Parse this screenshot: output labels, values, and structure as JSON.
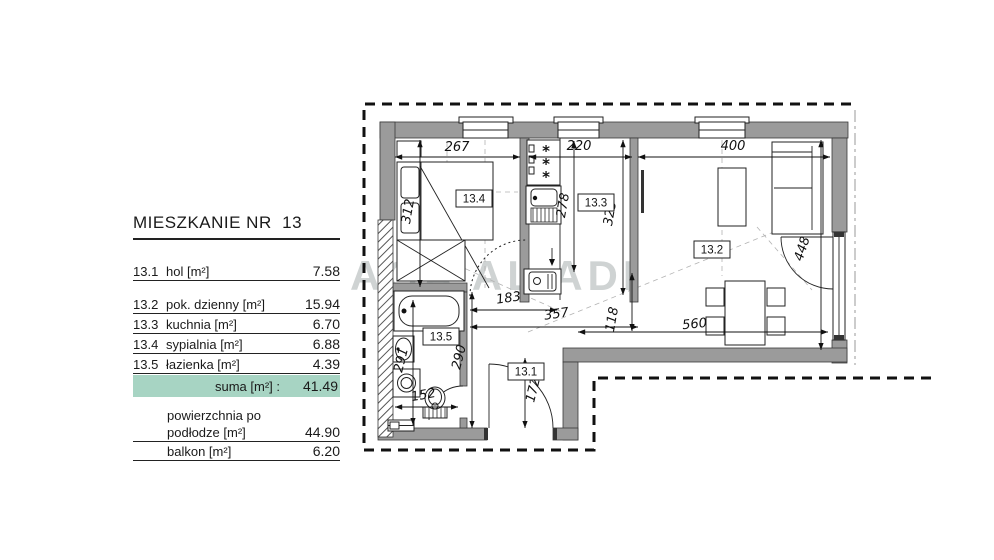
{
  "panel": {
    "title": "MIESZKANIE NR  13",
    "rows": [
      {
        "code": "13.1",
        "label": "hol [m²]",
        "value": "7.58"
      },
      {
        "code": "13.2",
        "label": "pok. dzienny  [m²]",
        "value": "15.94"
      },
      {
        "code": "13.3",
        "label": "kuchnia [m²]",
        "value": "6.70"
      },
      {
        "code": "13.4",
        "label": "sypialnia [m²]",
        "value": "6.88"
      },
      {
        "code": "13.5",
        "label": "łazienka [m²]",
        "value": "4.39"
      }
    ],
    "suma_label": "suma [m²] :",
    "suma_value": "41.49",
    "floor_area_label_line1": "powierzchnia po",
    "floor_area_label_line2": "podłodze [m²]",
    "floor_area_value": "44.90",
    "balcony_label": "balkon [m²]",
    "balcony_value": "6.20"
  },
  "plan": {
    "rooms": {
      "r131": "13.1",
      "r132": "13.2",
      "r133": "13.3",
      "r134": "13.4",
      "r135": "13.5"
    },
    "dims": {
      "d267": "267",
      "d220": "220",
      "d400": "400",
      "d312": "312",
      "d278": "278",
      "d325": "325",
      "d448": "448",
      "d183": "183",
      "d357": "357",
      "d118": "118",
      "d560": "560",
      "d291": "291",
      "d290": "290",
      "d172": "172",
      "d152": "152"
    },
    "icons": {
      "burner": "*"
    }
  },
  "watermark": {
    "text": "AGA AL ADI"
  },
  "colors": {
    "wall": "#9b9b9b",
    "suma_bg": "#a7d4c3",
    "boundary": "#111111"
  }
}
